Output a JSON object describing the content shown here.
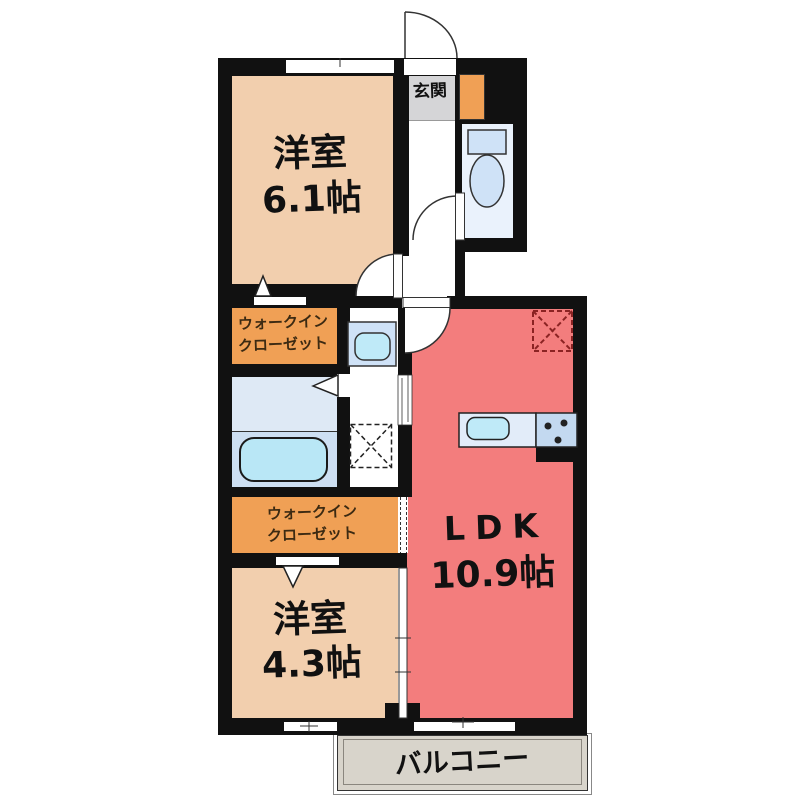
{
  "labels": {
    "entrance": "玄関",
    "bedroom1_name": "洋室",
    "bedroom1_size": "6.1帖",
    "closet1_line1": "ウォークイン",
    "closet1_line2": "クローゼット",
    "closet2_line1": "ウォークイン",
    "closet2_line2": "クローゼット",
    "bedroom2_name": "洋室",
    "bedroom2_size": "4.3帖",
    "ldk_name": "LDK",
    "ldk_size": "10.9帖",
    "balcony": "バルコニー"
  },
  "colors": {
    "wall": "#111111",
    "bedroom_floor": "#f2cfae",
    "ldk_floor": "#f37d7d",
    "closet_floor": "#f0a055",
    "entrance_floor": "#d5d5d7",
    "balcony_floor": "#d8d4cb",
    "toilet_floor": "#eaf2fc",
    "bath_upper": "#dee9f5",
    "bath_lower": "#cddff2",
    "fixture_blue": "#cfe2f7",
    "water_cyan": "#bfeaf8",
    "tub_cyan": "#b9e7f6",
    "counter_blue": "#e2ecf9",
    "stove_blue": "#c3d9f0",
    "fridge_dash": "#8b2323",
    "closet_text": "#3c2a12",
    "label_text": "#111111"
  }
}
